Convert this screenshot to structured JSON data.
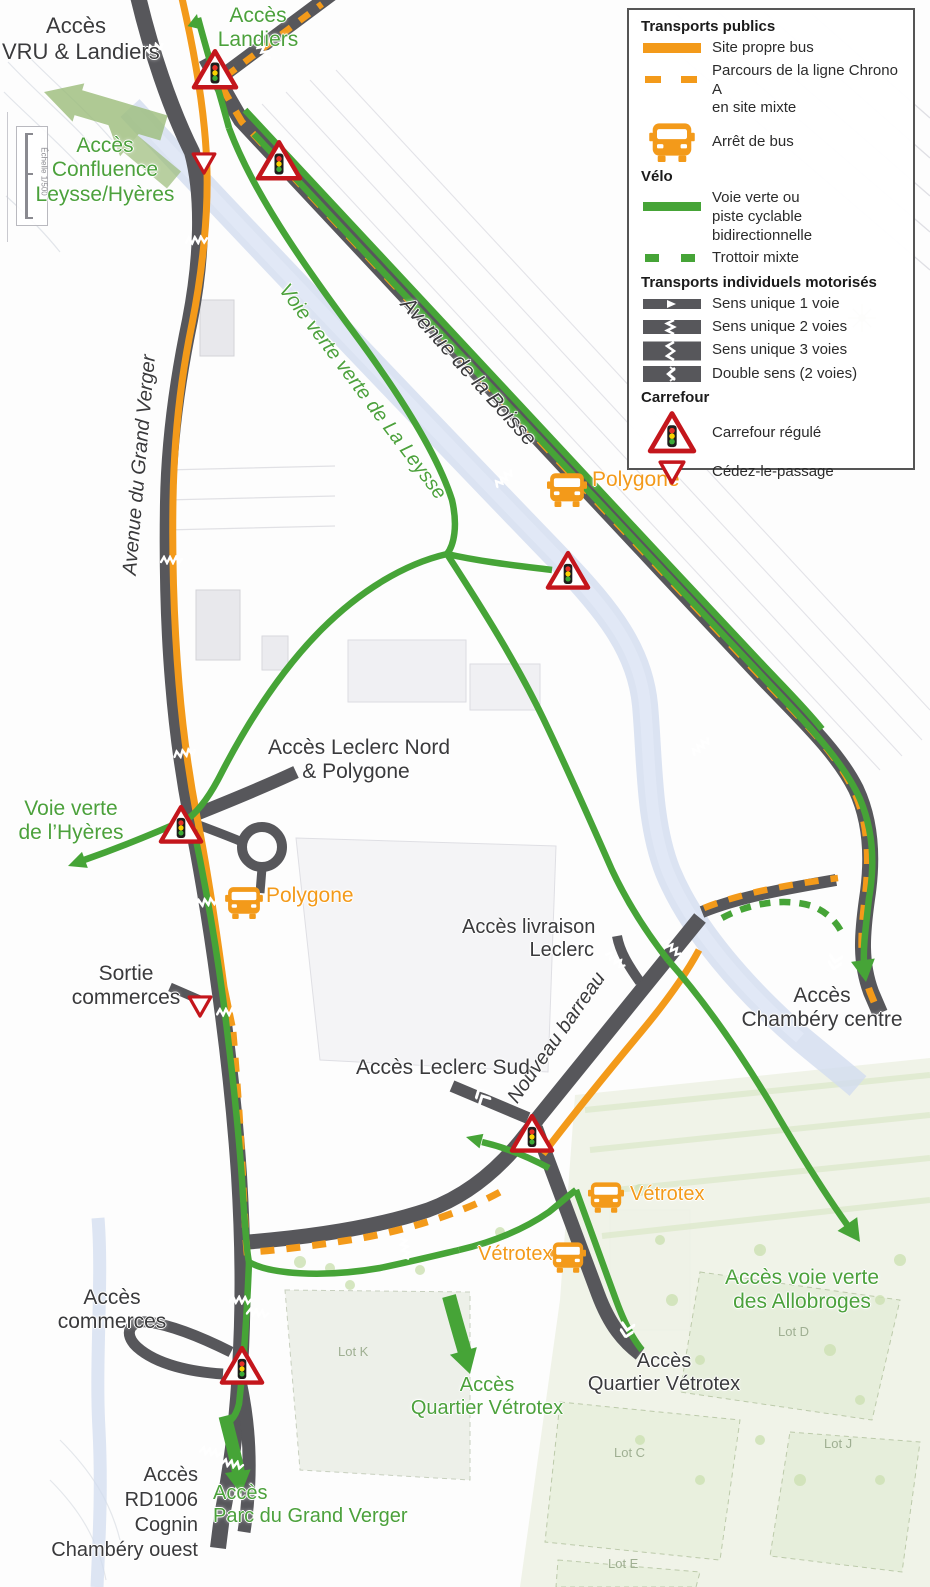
{
  "legend": {
    "sections": [
      {
        "title": "Transports publics",
        "items": [
          {
            "key": "site-propre-bus",
            "label": "Site propre bus"
          },
          {
            "key": "chrono-a-site-mixte",
            "label": "Parcours de la ligne Chrono A",
            "label2": "en site mixte"
          },
          {
            "key": "arret-de-bus",
            "label": "Arrêt de bus"
          }
        ]
      },
      {
        "title": "Vélo",
        "items": [
          {
            "key": "voie-verte",
            "label": "Voie verte ou",
            "label2": "piste cyclable bidirectionnelle"
          },
          {
            "key": "trottoir-mixte",
            "label": "Trottoir mixte"
          }
        ]
      },
      {
        "title": "Transports individuels motorisés",
        "items": [
          {
            "key": "sens-unique-1",
            "label": "Sens unique 1 voie"
          },
          {
            "key": "sens-unique-2",
            "label": "Sens unique 2 voies"
          },
          {
            "key": "sens-unique-3",
            "label": "Sens unique 3 voies"
          },
          {
            "key": "double-sens",
            "label": "Double sens (2 voies)"
          }
        ]
      },
      {
        "title": "Carrefour",
        "items": [
          {
            "key": "carrefour-regule",
            "label": "Carrefour régulé"
          },
          {
            "key": "cedez-le-passage",
            "label": "Cédez-le-passage"
          }
        ]
      }
    ]
  },
  "labels": {
    "acces_vru": [
      "Accès",
      "VRU & Landiers"
    ],
    "acces_landiers": [
      "Accès",
      "Landiers"
    ],
    "acces_confluence": [
      "Accès",
      "Confluence",
      "Leysse/Hyères"
    ],
    "avenue_grand_verger": "Avenue du Grand Verger",
    "voie_verte_leysse": "Voie verte verte de La Leysse",
    "avenue_boisse": "Avenue de la Boisse",
    "acces_leclerc_nord": [
      "Accès Leclerc Nord",
      "& Polygone"
    ],
    "voie_verte_hyeres": [
      "Voie verte",
      "de l’Hyères"
    ],
    "sortie_commerces": [
      "Sortie",
      "commerces"
    ],
    "acces_livraison": [
      "Accès livraison",
      "Leclerc"
    ],
    "nouveau_barreau": "Nouveau barreau",
    "acces_chambery": [
      "Accès",
      "Chambéry centre"
    ],
    "acces_leclerc_sud": "Accès Leclerc Sud",
    "acces_allobroges": [
      "Accès voie verte",
      "des Allobroges"
    ],
    "acces_commerces": [
      "Accès",
      "commerces"
    ],
    "acces_quartier_vetrotex_sud": [
      "Accès",
      "Quartier Vétrotex"
    ],
    "acces_quartier_vetrotex_est": [
      "Accès",
      "Quartier Vétrotex"
    ],
    "acces_rd1006": [
      "Accès",
      "RD1006",
      "Cognin",
      "Chambéry ouest"
    ],
    "acces_parc": [
      "Accès",
      "Parc du Grand Verger"
    ],
    "lots": [
      "Lot K",
      "Lot D",
      "Lot C",
      "Lot J",
      "Lot E"
    ],
    "scale": "Échelle 1/500"
  },
  "bus_stops": [
    "Polygone",
    "Polygone",
    "Vétrotex",
    "Vétrotex"
  ],
  "colors": {
    "bus_orange": "#F39A1A",
    "bike_green": "#46A437",
    "road_gray": "#57575B",
    "signal_red": "#C4161C",
    "river_blue": "#D2DCEF",
    "access_arrow_green": "#9CBD7B",
    "label_black": "#3A3A3C",
    "label_green": "#4CA13C"
  },
  "icons": {
    "bus_stop": "bus-icon",
    "carrefour_regule": "traffic-signal-triangle-icon",
    "cedez_le_passage": "yield-triangle-icon",
    "access_arrow": "access-arrow-icon"
  }
}
